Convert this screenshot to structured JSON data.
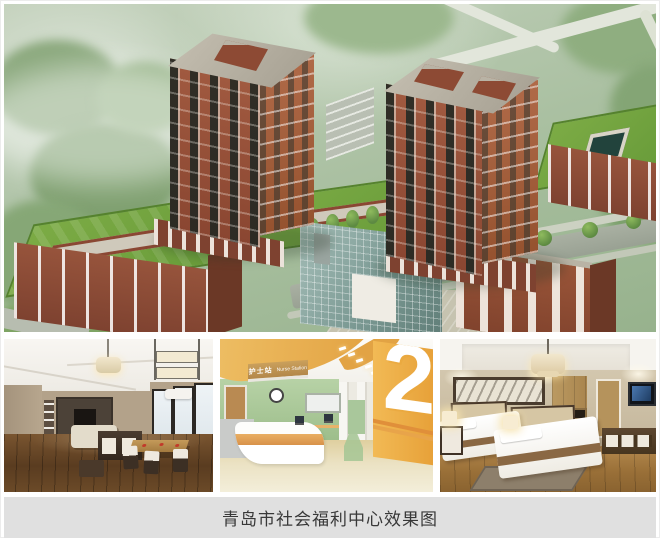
{
  "caption": {
    "text": "青岛市社会福利中心效果图"
  },
  "nurse_station": {
    "sign_cn": "护士站",
    "sign_en": "Nurse Station",
    "floor_number": "2"
  },
  "colors": {
    "caption_background": "#e0e0e0",
    "brick_red": "#98523a",
    "roof_green": "#73a641",
    "glass_teal": "#7e9c96",
    "ward_wall_green": "#abc99c",
    "accent_orange": "#e8a44a"
  }
}
